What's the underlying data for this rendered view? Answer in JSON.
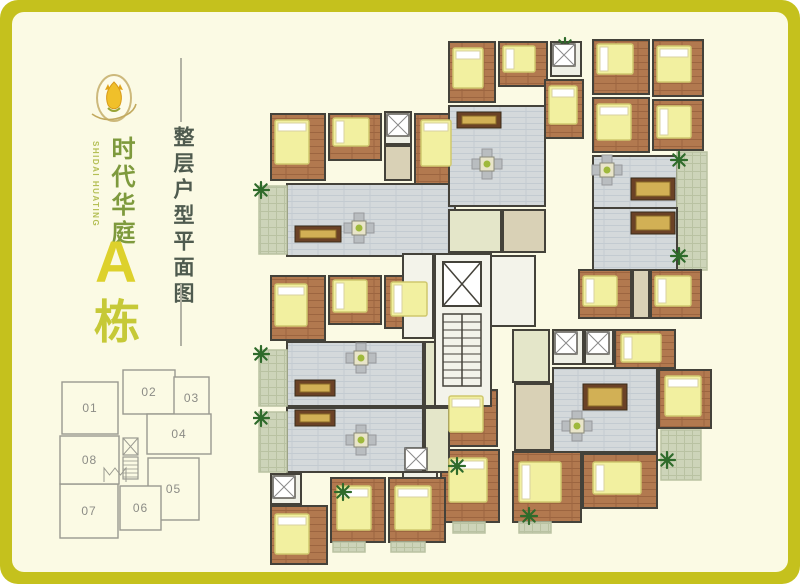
{
  "brand": {
    "en": "SHIDAI HUATING",
    "cn": "时代华庭",
    "block": "A",
    "suffix": "栋"
  },
  "title": {
    "text": "整层户型平面图"
  },
  "colors": {
    "border": "#c5c11d",
    "background": "#fbfae4",
    "wall": "#44423a",
    "wood": "#b2794f",
    "wood_line": "#9c6540",
    "living": "#d4d9db",
    "living_line": "#c3cbd1",
    "kitchen": "#e4e6c9",
    "bath": "#eff0e6",
    "corridor": "#d9d1b6",
    "balcony": "#cdd4b9",
    "balcony_line": "#b9c2a2",
    "bed": "#f2f0a0",
    "bed_edge": "#cfc86e",
    "pillow": "#ffffff",
    "plant": "#2f6b2b",
    "tv": "#6b4226",
    "tv_gold": "#d2b055",
    "table": "#e9e5c9",
    "chair": "#b9bdc0",
    "core": "#f3f3ea",
    "key_line": "#9a9a90",
    "key_text": "#8c8c86",
    "brand_green": "#7e9a3d",
    "brand_yellow": "#ddd12c",
    "title_color": "#4f5b4f",
    "divider": "#b2b2a4"
  },
  "key_plan": {
    "units": [
      {
        "label": "01",
        "x": 62,
        "y": 382,
        "w": 56,
        "h": 52
      },
      {
        "label": "02",
        "x": 123,
        "y": 370,
        "w": 52,
        "h": 44
      },
      {
        "label": "03",
        "x": 174,
        "y": 377,
        "w": 35,
        "h": 42
      },
      {
        "label": "04",
        "x": 147,
        "y": 414,
        "w": 64,
        "h": 40
      },
      {
        "label": "05",
        "x": 148,
        "y": 458,
        "w": 51,
        "h": 62
      },
      {
        "label": "06",
        "x": 120,
        "y": 486,
        "w": 41,
        "h": 44
      },
      {
        "label": "07",
        "x": 60,
        "y": 484,
        "w": 58,
        "h": 54
      },
      {
        "label": "08",
        "x": 60,
        "y": 436,
        "w": 59,
        "h": 48
      }
    ],
    "core": {
      "elevator": [
        123,
        438,
        15,
        17
      ],
      "stairs": [
        123,
        457,
        15,
        22
      ],
      "porch": [
        104,
        468,
        22,
        14
      ]
    }
  },
  "plan": {
    "x": 253,
    "y": 28,
    "w": 520,
    "h": 540,
    "rooms": [
      [
        "bedroom",
        18,
        86,
        54,
        66
      ],
      [
        "bedroom",
        76,
        86,
        52,
        46
      ],
      [
        "bath",
        132,
        84,
        26,
        32
      ],
      [
        "corridor",
        132,
        118,
        26,
        34
      ],
      [
        "bedroom",
        162,
        86,
        40,
        70
      ],
      [
        "living",
        34,
        156,
        168,
        72
      ],
      [
        "balcony",
        6,
        158,
        28,
        68
      ],
      [
        "bedroom",
        196,
        14,
        46,
        60
      ],
      [
        "bedroom",
        246,
        14,
        48,
        44
      ],
      [
        "bath",
        298,
        14,
        30,
        34
      ],
      [
        "bedroom",
        292,
        52,
        38,
        58
      ],
      [
        "living",
        196,
        78,
        96,
        100
      ],
      [
        "kitchen",
        196,
        182,
        52,
        42
      ],
      [
        "corridor",
        250,
        182,
        42,
        42
      ],
      [
        "bedroom",
        340,
        12,
        56,
        54
      ],
      [
        "bedroom",
        400,
        12,
        50,
        56
      ],
      [
        "bedroom",
        340,
        70,
        56,
        54
      ],
      [
        "bedroom",
        400,
        72,
        50,
        50
      ],
      [
        "living",
        340,
        128,
        84,
        52
      ],
      [
        "balcony",
        424,
        124,
        30,
        118
      ],
      [
        "living",
        340,
        180,
        84,
        62
      ],
      [
        "bedroom",
        326,
        242,
        52,
        48
      ],
      [
        "corridor",
        380,
        242,
        16,
        48
      ],
      [
        "bedroom",
        398,
        242,
        50,
        48
      ],
      [
        "kitchen",
        260,
        302,
        36,
        52
      ],
      [
        "bath",
        300,
        302,
        30,
        34
      ],
      [
        "bath",
        332,
        302,
        28,
        34
      ],
      [
        "bedroom",
        362,
        302,
        60,
        38
      ],
      [
        "living",
        300,
        340,
        104,
        84
      ],
      [
        "bedroom",
        406,
        342,
        52,
        58
      ],
      [
        "bedroom",
        330,
        426,
        74,
        54
      ],
      [
        "bedroom",
        260,
        424,
        68,
        70
      ],
      [
        "balcony",
        408,
        402,
        40,
        50
      ],
      [
        "corridor",
        262,
        356,
        36,
        66
      ],
      [
        "kitchen",
        150,
        362,
        36,
        52
      ],
      [
        "bedroom",
        190,
        362,
        54,
        56
      ],
      [
        "bath",
        150,
        418,
        34,
        34
      ],
      [
        "bedroom",
        188,
        422,
        58,
        72
      ],
      [
        "corridor",
        150,
        456,
        36,
        36
      ],
      [
        "balcony",
        200,
        494,
        32,
        11
      ],
      [
        "balcony",
        266,
        494,
        32,
        11
      ],
      [
        "living",
        34,
        380,
        136,
        64
      ],
      [
        "kitchen",
        172,
        380,
        24,
        64
      ],
      [
        "balcony",
        6,
        384,
        28,
        60
      ],
      [
        "bath",
        18,
        446,
        30,
        30
      ],
      [
        "bedroom",
        18,
        478,
        56,
        58
      ],
      [
        "bedroom",
        78,
        450,
        54,
        64
      ],
      [
        "bedroom",
        136,
        450,
        56,
        64
      ],
      [
        "balcony",
        80,
        514,
        32,
        10
      ],
      [
        "balcony",
        138,
        514,
        34,
        10
      ],
      [
        "bedroom",
        18,
        248,
        54,
        64
      ],
      [
        "bedroom",
        76,
        248,
        52,
        48
      ],
      [
        "bedroom",
        132,
        248,
        56,
        52
      ],
      [
        "living",
        34,
        314,
        136,
        64
      ],
      [
        "kitchen",
        172,
        314,
        24,
        64
      ],
      [
        "balcony",
        6,
        322,
        28,
        56
      ],
      [
        "hall",
        150,
        226,
        30,
        84
      ],
      [
        "hall",
        238,
        228,
        44,
        70
      ]
    ],
    "core": {
      "box": [
        182,
        226,
        56,
        152
      ],
      "elevator": [
        190,
        234,
        38,
        44
      ],
      "stairs": [
        190,
        286,
        38,
        72
      ]
    },
    "beds": [
      [
        22,
        92,
        34,
        44
      ],
      [
        80,
        90,
        36,
        28
      ],
      [
        168,
        92,
        30,
        46
      ],
      [
        200,
        20,
        30,
        40
      ],
      [
        250,
        18,
        32,
        26
      ],
      [
        296,
        58,
        28,
        38
      ],
      [
        344,
        16,
        36,
        30
      ],
      [
        404,
        18,
        34,
        36
      ],
      [
        344,
        76,
        34,
        36
      ],
      [
        404,
        78,
        34,
        32
      ],
      [
        330,
        248,
        34,
        30
      ],
      [
        402,
        248,
        36,
        30
      ],
      [
        368,
        306,
        40,
        28
      ],
      [
        412,
        348,
        36,
        40
      ],
      [
        340,
        434,
        48,
        32
      ],
      [
        266,
        434,
        42,
        40
      ],
      [
        196,
        368,
        34,
        36
      ],
      [
        196,
        430,
        38,
        44
      ],
      [
        22,
        486,
        34,
        40
      ],
      [
        84,
        458,
        34,
        44
      ],
      [
        142,
        458,
        36,
        44
      ],
      [
        22,
        256,
        32,
        42
      ],
      [
        80,
        252,
        34,
        32
      ],
      [
        138,
        254,
        36,
        34
      ]
    ],
    "tv_stands": [
      [
        42,
        198,
        46,
        16
      ],
      [
        204,
        84,
        44,
        16
      ],
      [
        378,
        150,
        44,
        22
      ],
      [
        378,
        184,
        44,
        22
      ],
      [
        330,
        356,
        44,
        26
      ],
      [
        42,
        352,
        40,
        16
      ],
      [
        42,
        382,
        40,
        16
      ]
    ],
    "dining_sets": [
      [
        106,
        200
      ],
      [
        234,
        136
      ],
      [
        354,
        142
      ],
      [
        324,
        398
      ],
      [
        108,
        330
      ],
      [
        108,
        412
      ]
    ],
    "plants": [
      [
        8,
        162
      ],
      [
        8,
        326
      ],
      [
        8,
        390
      ],
      [
        312,
        18
      ],
      [
        426,
        132
      ],
      [
        426,
        228
      ],
      [
        414,
        432
      ],
      [
        276,
        488
      ],
      [
        90,
        464
      ],
      [
        204,
        438
      ]
    ],
    "showers": [
      [
        134,
        86
      ],
      [
        300,
        16
      ],
      [
        302,
        304
      ],
      [
        334,
        304
      ],
      [
        152,
        420
      ],
      [
        20,
        448
      ]
    ]
  }
}
